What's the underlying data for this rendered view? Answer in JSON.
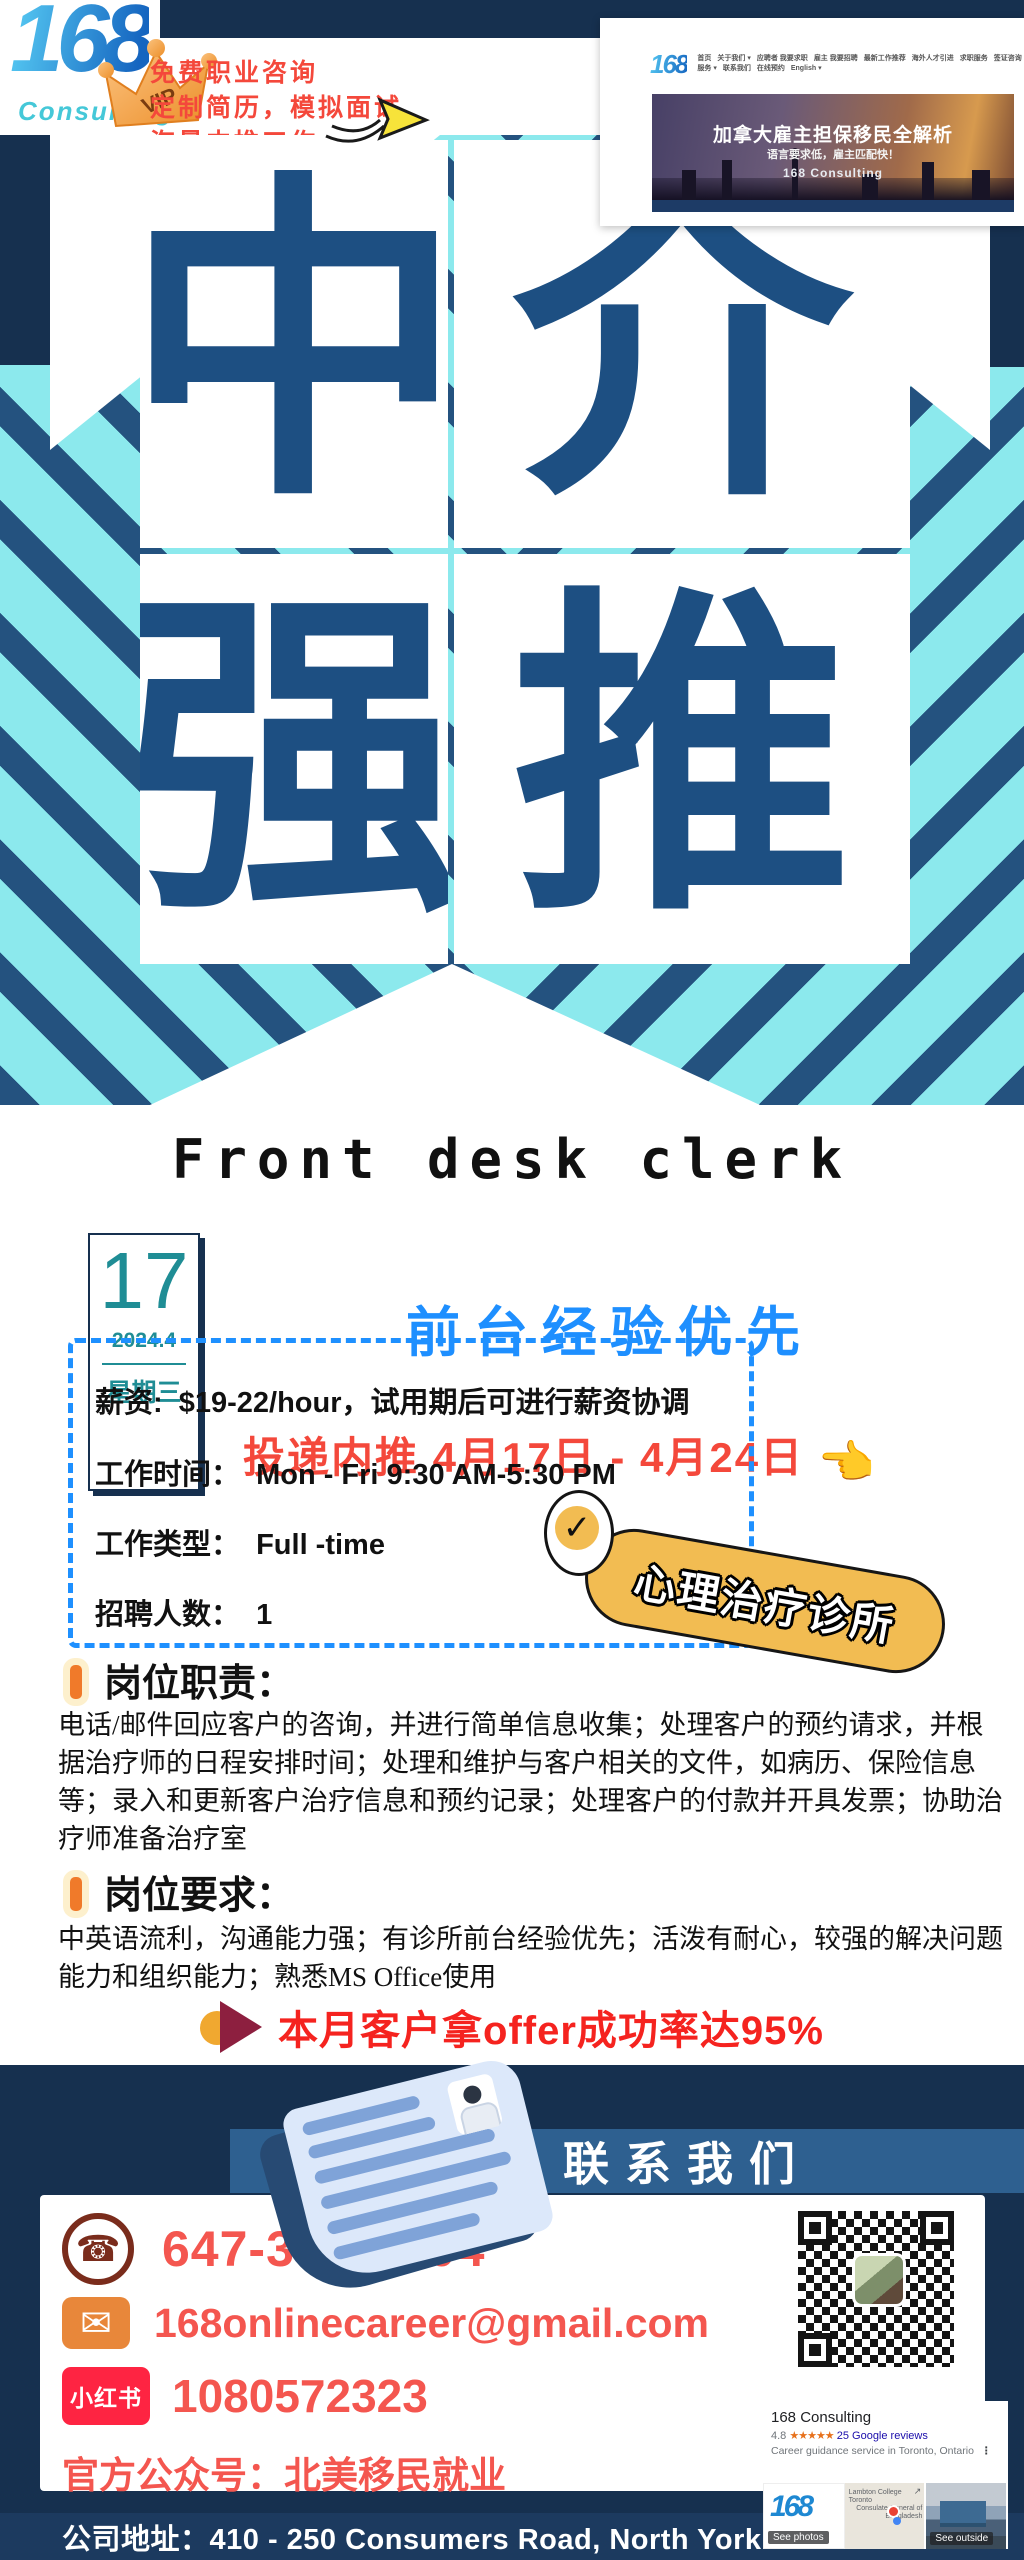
{
  "colors": {
    "navy": "#16304f",
    "stripe_navy": "#24527f",
    "stripe_teal": "#8ce9ed",
    "char_blue": "#1d4f82",
    "slogan_red": "#f4483b",
    "contact_coral": "#f4564f",
    "subtitle_blue": "#1e8fff",
    "date_teal": "#1f8d95",
    "banner_blue": "#2e6090",
    "badge_yellow": "#f2bc52",
    "xhs_red": "#fe2442",
    "email_orange": "#e8873a"
  },
  "header": {
    "logo_text": "168",
    "logo_sub": "Consulting",
    "vip": "VIP",
    "slogan_lines": [
      "免费职业咨询",
      "定制简历，模拟面试",
      "海量内推工作"
    ],
    "site": {
      "nav_logo": "168",
      "nav_items": [
        "首页",
        "关于我们 ▾",
        "应聘者 我要求职",
        "雇主 我要招聘",
        "最新工作推荐",
        "海外人才引进",
        "求职服务",
        "签证咨询服务 ▾",
        "联系我们",
        "在线预约",
        "English ▾"
      ],
      "hero_title": "加拿大雇主担保移民全解析",
      "hero_subtitle": "语言要求低，雇主匹配快！",
      "hero_brand": "168 Consulting"
    }
  },
  "banner_chars": [
    "中",
    "介",
    "强",
    "推"
  ],
  "job": {
    "title_en": "Front desk clerk",
    "date": {
      "day": "17",
      "month": "2024.4",
      "weekday": "星期三"
    },
    "subtitle": "前台经验优先",
    "apply_window": "投递内推 4月17日 - 4月24日",
    "pointer": "👈",
    "check": "✓",
    "details": [
      {
        "label": "薪资:",
        "value": "$19-22/hour，试用期后可进行薪资协调"
      },
      {
        "label": "工作时间：",
        "value": "Mon - Fri 9:30 AM-5:30 PM"
      },
      {
        "label": "工作类型：",
        "value": "Full -time"
      },
      {
        "label": "招聘人数：",
        "value": "1"
      }
    ],
    "clinic_badge": "心理治疗诊所",
    "resp_title": "岗位职责：",
    "resp_text": "电话/邮件回应客户的咨询，并进行简单信息收集；处理客户的预约请求，并根据治疗师的日程安排时间；处理和维护与客户相关的文件，如病历、保险信息等；录入和更新客户治疗信息和预约记录；处理客户的付款并开具发票；协助治疗师准备治疗室",
    "req_title": "岗位要求：",
    "req_text": "中英语流利，沟通能力强；有诊所前台经验优先；活泼有耐心，较强的解决问题能力和组织能力；熟悉MS Office使用",
    "offer_line": "本月客户拿offer成功率达95%"
  },
  "contact": {
    "banner": "联系我们",
    "phone": "647-349-8804",
    "email": "168onlinecareer@gmail.com",
    "xhs_label": "小红书",
    "xhs_id": "1080572323",
    "wechat_line": "官方公众号：北美移民就业",
    "address_line": "公司地址：410 - 250 Consumers Road, North York"
  },
  "google_card": {
    "name": "168 Consulting",
    "rating": "4.8",
    "stars": "★★★★★",
    "reviews": "25 Google reviews",
    "category": "Career guidance service in Toronto, Ontario",
    "more_icon": "⋮",
    "expand_icon": "↗",
    "map_text_a": "Lambton College Toronto",
    "map_text_b": "Consulate General of Bangladesh",
    "thumb_photos_label": "See photos",
    "thumb_outside_label": "See outside"
  }
}
